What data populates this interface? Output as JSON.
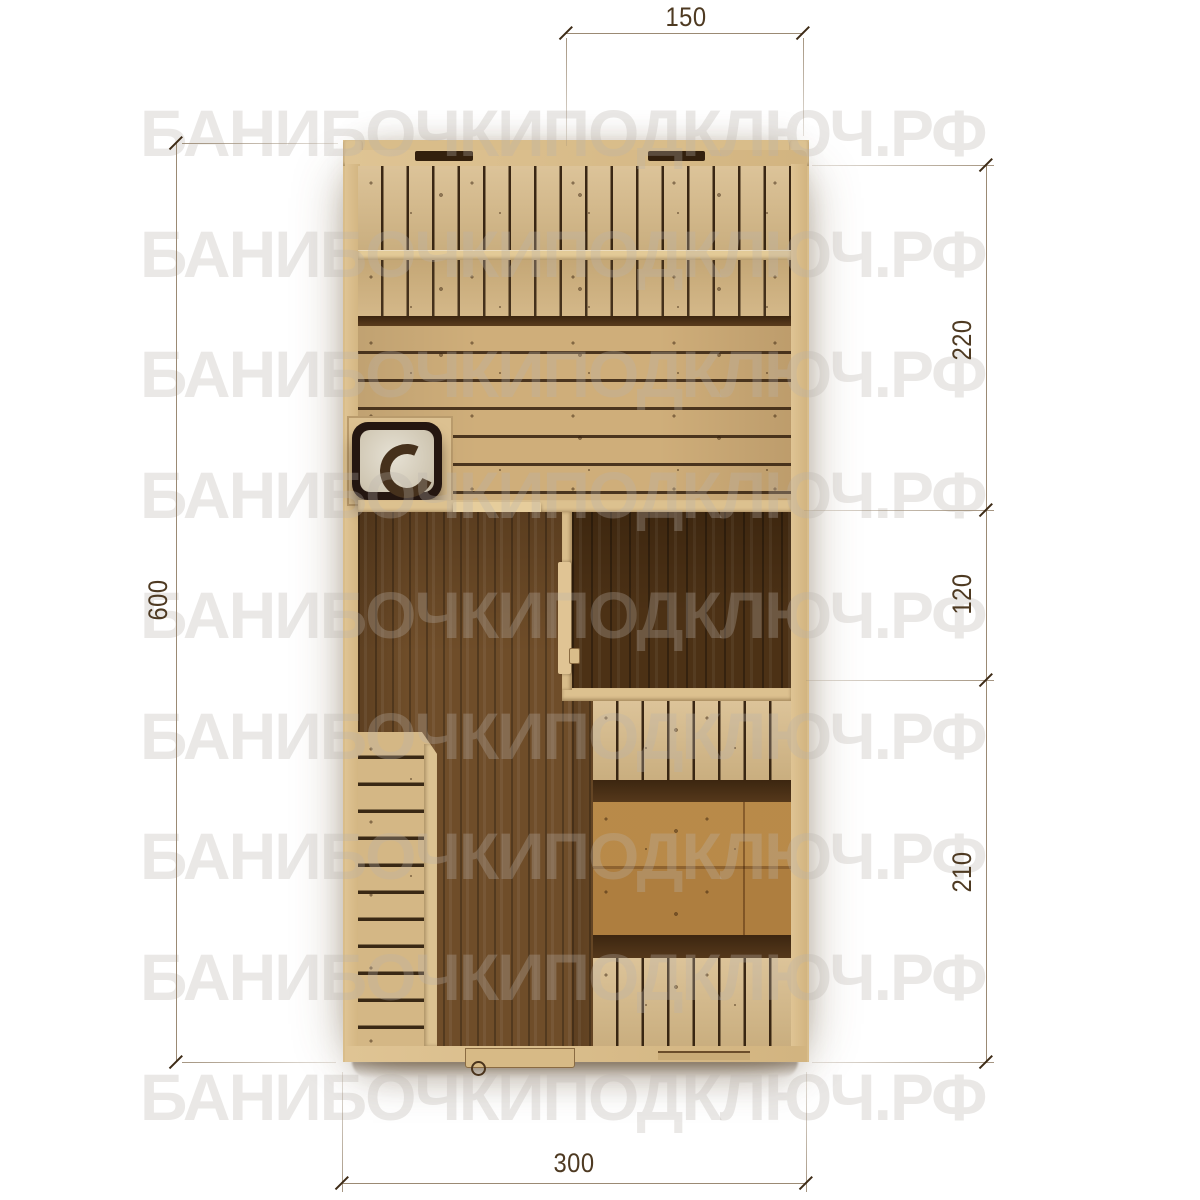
{
  "page": {
    "background": "#ffffff",
    "content": "Sauna (banya) floor plan, top view, with dimension lines and site watermark"
  },
  "watermark": {
    "text": "БАНИБОЧКИПОДКЛЮЧ.РФ",
    "color": "#ececec",
    "rows": 9
  },
  "dimensions": {
    "top": {
      "label": "150"
    },
    "right": [
      {
        "label": "220"
      },
      {
        "label": "120"
      },
      {
        "label": "210"
      }
    ],
    "left": {
      "label": "600"
    },
    "bottom": {
      "label": "300"
    }
  },
  "features": {
    "stove": "stove-top-view-icon",
    "steam_room_bench": "two-tier-slatted-bench",
    "doors": "door-leaves-on-partitions-and-bottom-wall"
  },
  "colors": {
    "wood_light": "#d7ba87",
    "wood_rail": "#e3ca97",
    "wood_floor_planks": "#cfae7a",
    "plank_gap": "#3a2511",
    "washroom_floor": "#6f4d29",
    "dark_room_floor": "#4c3115",
    "stove_body": "#241610",
    "stove_top": "#d8d2c4",
    "dimension_text": "#4e3a22",
    "dimension_line": "#9b8a74",
    "watermark_on_white": "#ececec"
  }
}
